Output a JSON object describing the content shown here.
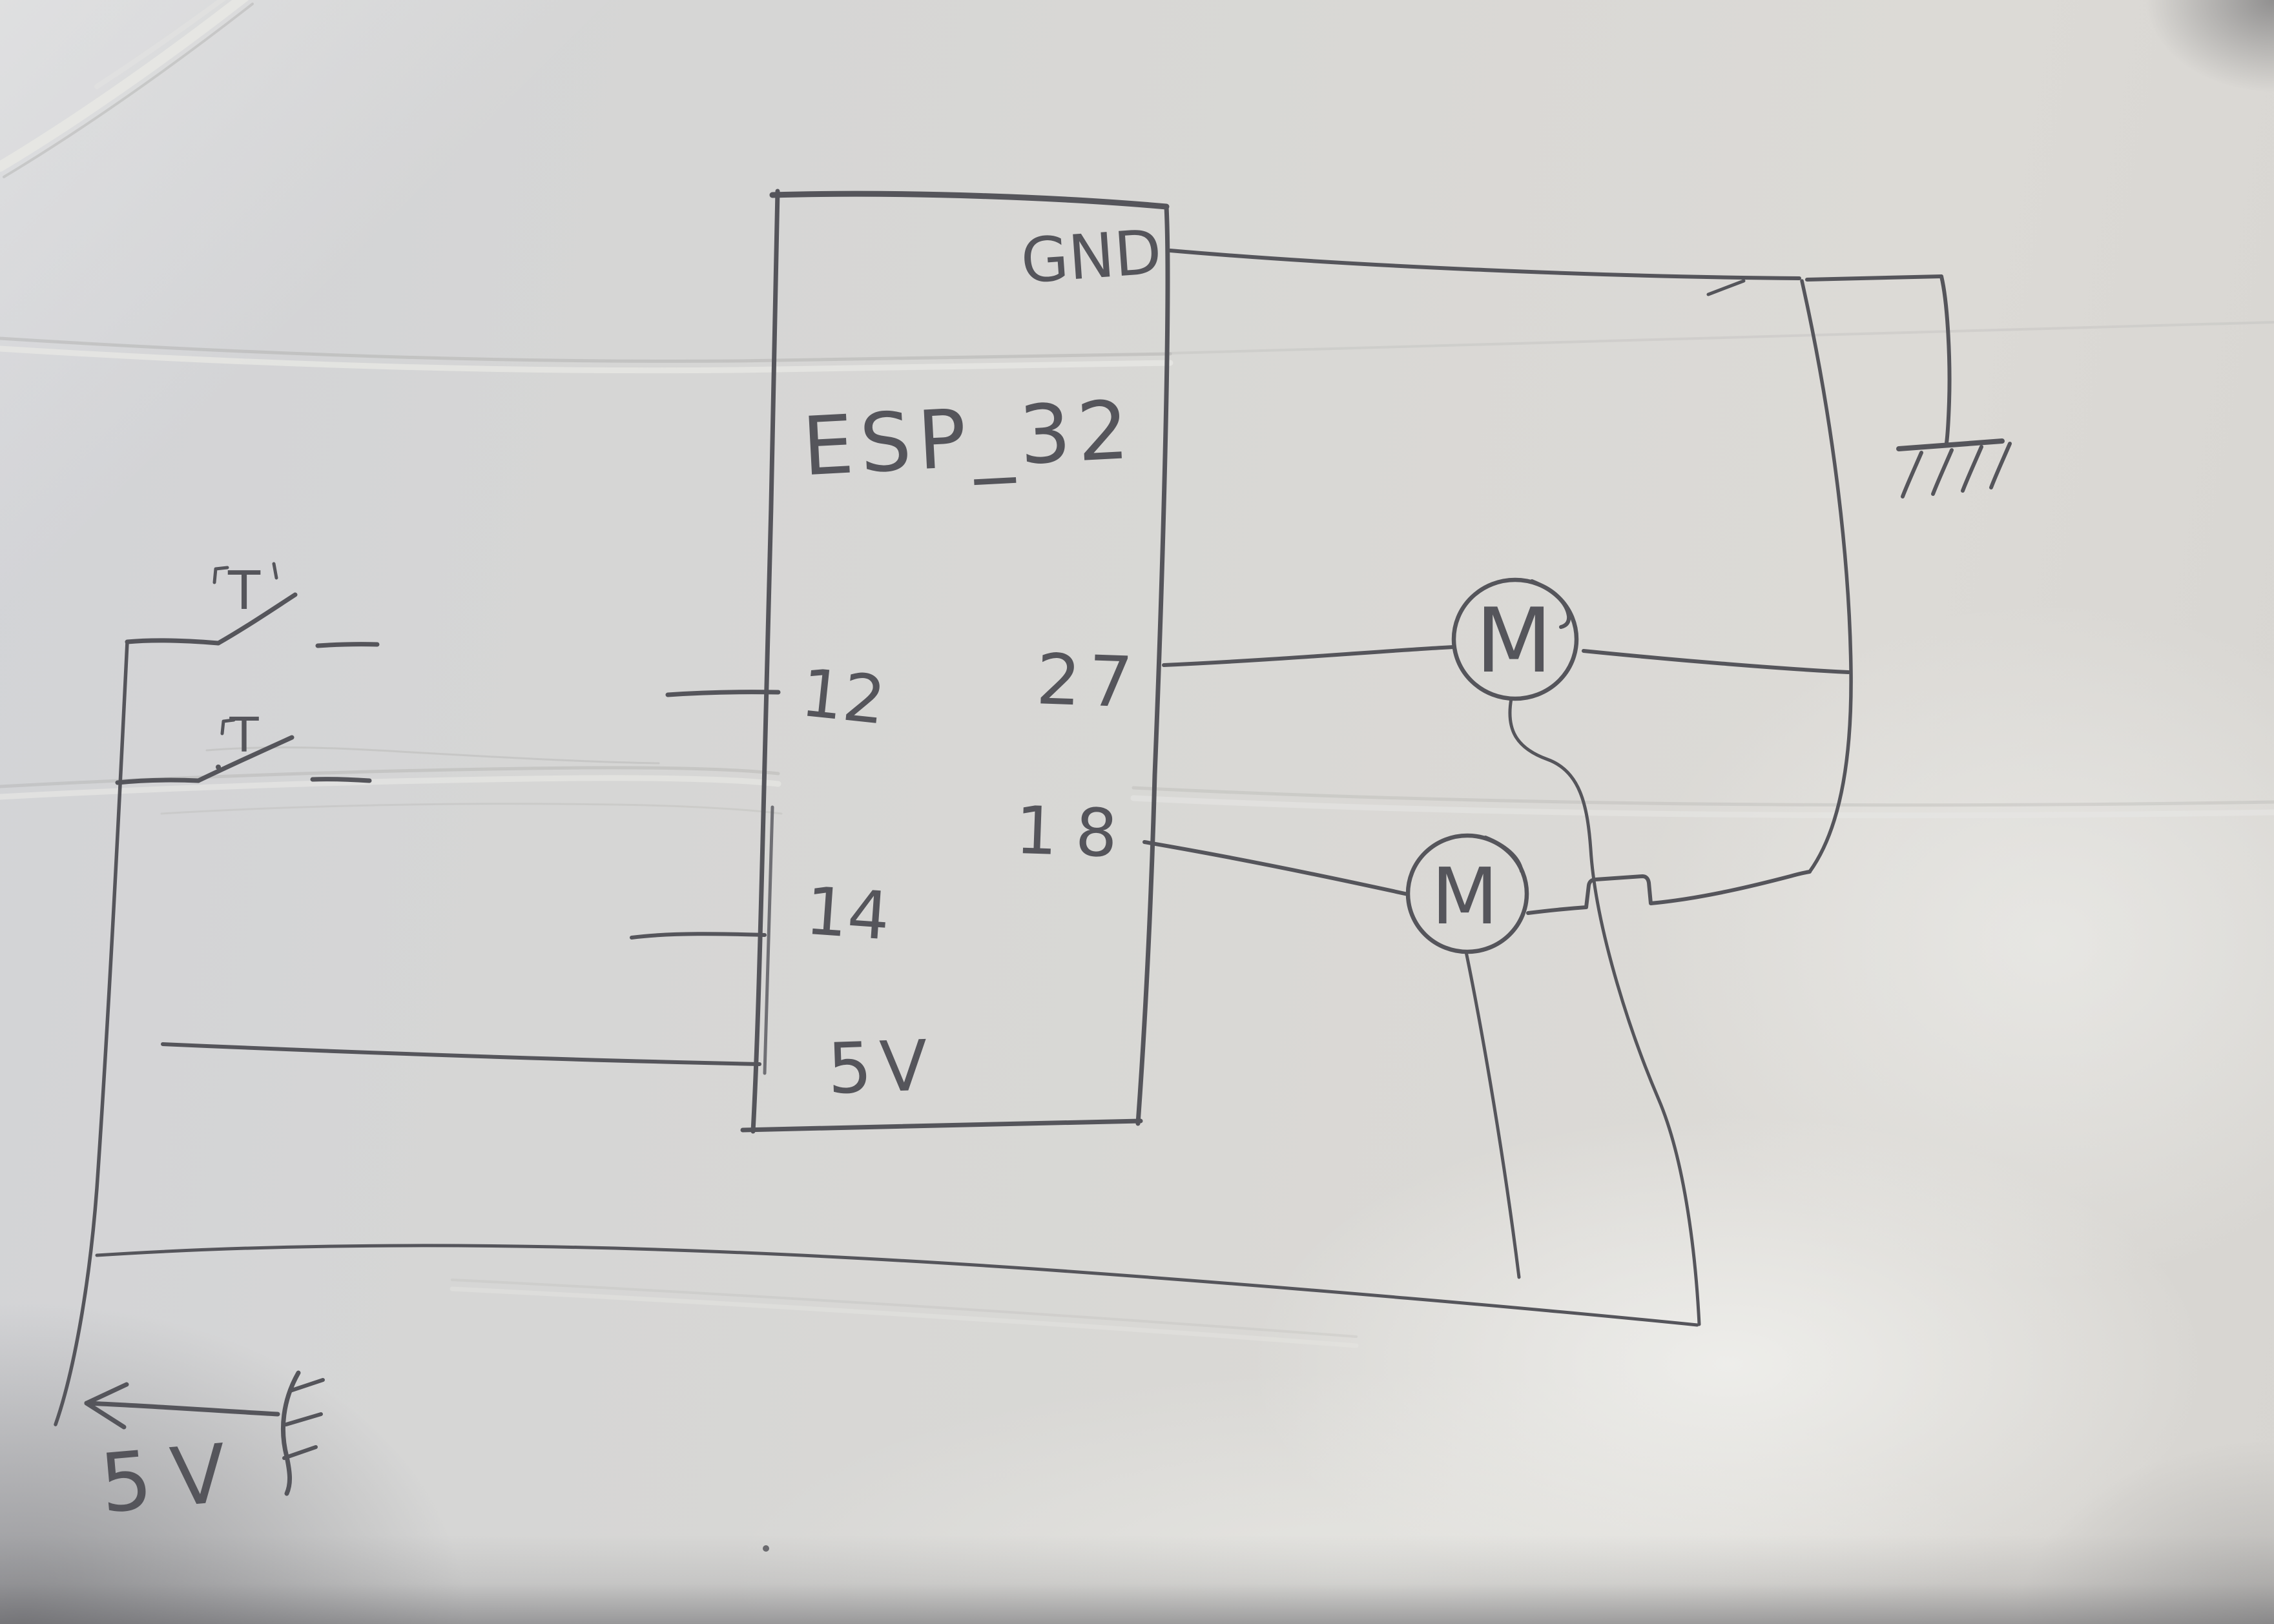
{
  "diagram": {
    "kind": "hand-drawn pencil circuit sketch on paper",
    "chip": {
      "title": "ESP_32",
      "pins": {
        "gnd": "GND",
        "left_top": "12",
        "left_mid": "14",
        "bottom": "5V",
        "right_top": "27",
        "right_mid": "18"
      }
    },
    "switches": {
      "sw1_label": "T",
      "sw2_label": "T"
    },
    "motors": {
      "m1_label": "M",
      "m2_label": "M"
    },
    "power": {
      "supply_label": "5V"
    },
    "icons": {
      "ground_symbol": "earth-ground-icon",
      "source_symbol": "emf-source-icon",
      "arrow_symbol": "left-arrow-icon"
    },
    "colors": {
      "pencil": "#55555b",
      "pencil_light": "#85858a",
      "crease_dark": "#a7a7a5",
      "crease_light": "#e9e9e6",
      "paper": "#d7d7d5"
    }
  }
}
